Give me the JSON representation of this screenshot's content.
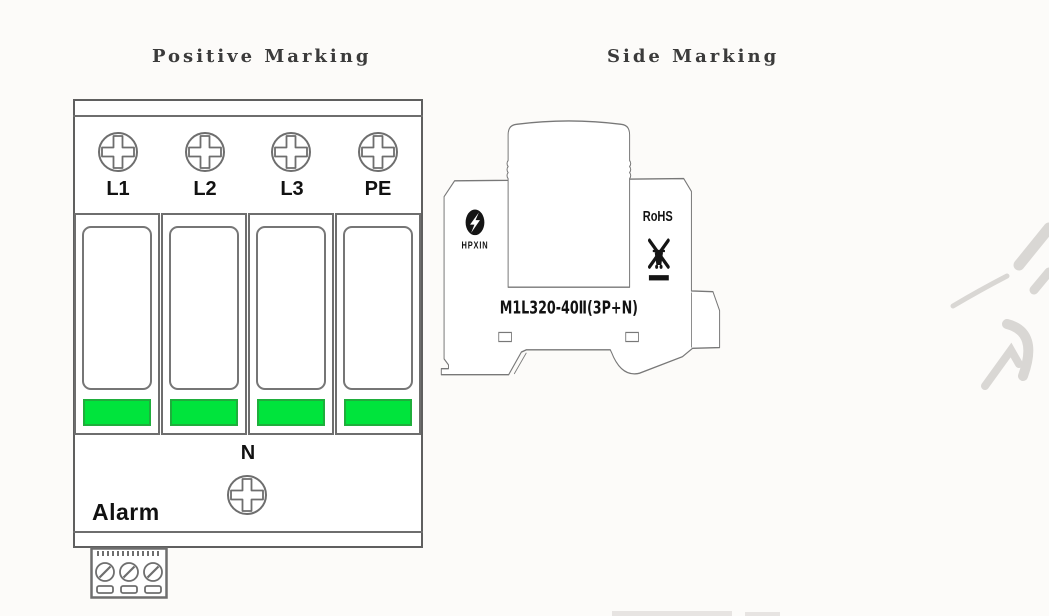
{
  "titles": {
    "left": "Positive Marking",
    "right": "Side Marking"
  },
  "front_view": {
    "terminals": [
      {
        "label": "L1"
      },
      {
        "label": "L2"
      },
      {
        "label": "L3"
      },
      {
        "label": "PE"
      }
    ],
    "neutral_terminal_label": "N",
    "alarm_label": "Alarm",
    "module_count": 4,
    "bottom_terminal_screw_count": 3,
    "status_indicator_color": "#00e43c"
  },
  "side_view": {
    "brand": "HPXIN",
    "rohs_label": "RoHS",
    "model_label": "M1L320-40Ⅱ(3P+N)"
  },
  "colors": {
    "outline": "#6e6e6e",
    "label_text": "#121212",
    "indicator_green": "#00e43c",
    "watermark_grey": "#d4d1ce",
    "background": "#fcfbf9"
  }
}
